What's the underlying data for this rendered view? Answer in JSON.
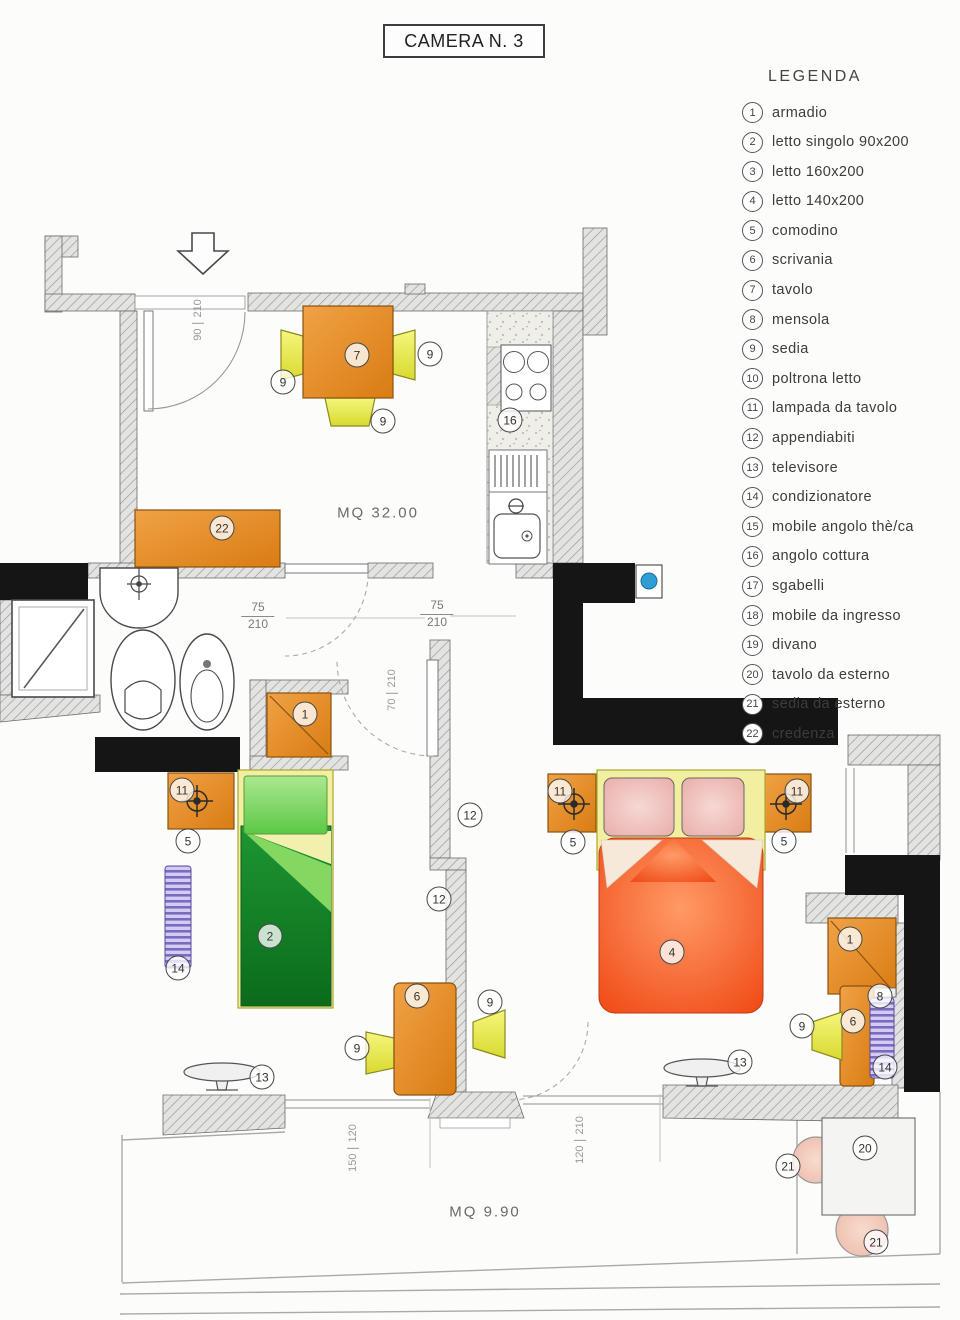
{
  "title": "CAMERA N. 3",
  "legend": {
    "heading": "LEGENDA",
    "items": [
      {
        "num": "1",
        "label": "armadio"
      },
      {
        "num": "2",
        "label": "letto singolo 90x200"
      },
      {
        "num": "3",
        "label": "letto 160x200"
      },
      {
        "num": "4",
        "label": "letto 140x200"
      },
      {
        "num": "5",
        "label": "comodino"
      },
      {
        "num": "6",
        "label": "scrivania"
      },
      {
        "num": "7",
        "label": "tavolo"
      },
      {
        "num": "8",
        "label": "mensola"
      },
      {
        "num": "9",
        "label": "sedia"
      },
      {
        "num": "10",
        "label": "poltrona letto"
      },
      {
        "num": "11",
        "label": "lampada da tavolo"
      },
      {
        "num": "12",
        "label": "appendiabiti"
      },
      {
        "num": "13",
        "label": "televisore"
      },
      {
        "num": "14",
        "label": "condizionatore"
      },
      {
        "num": "15",
        "label": "mobile angolo thè/ca"
      },
      {
        "num": "16",
        "label": "angolo cottura"
      },
      {
        "num": "17",
        "label": "sgabelli"
      },
      {
        "num": "18",
        "label": "mobile da ingresso"
      },
      {
        "num": "19",
        "label": "divano"
      },
      {
        "num": "20",
        "label": "tavolo da esterno"
      },
      {
        "num": "21",
        "label": "sedia da esterno"
      },
      {
        "num": "22",
        "label": "credenza"
      }
    ]
  },
  "plan": {
    "area_labels": [
      {
        "text": "MQ 32.00",
        "x": 378,
        "y": 513
      },
      {
        "text": "MQ 9.90",
        "x": 485,
        "y": 1212
      }
    ],
    "markers": [
      {
        "n": "7",
        "x": 357,
        "y": 355
      },
      {
        "n": "9",
        "x": 283,
        "y": 382
      },
      {
        "n": "9",
        "x": 430,
        "y": 354
      },
      {
        "n": "9",
        "x": 383,
        "y": 421
      },
      {
        "n": "16",
        "x": 510,
        "y": 420
      },
      {
        "n": "22",
        "x": 222,
        "y": 528
      },
      {
        "n": "1",
        "x": 305,
        "y": 714
      },
      {
        "n": "12",
        "x": 470,
        "y": 815
      },
      {
        "n": "12",
        "x": 439,
        "y": 899
      },
      {
        "n": "11",
        "x": 182,
        "y": 790
      },
      {
        "n": "5",
        "x": 188,
        "y": 841
      },
      {
        "n": "2",
        "x": 270,
        "y": 936
      },
      {
        "n": "14",
        "x": 178,
        "y": 968
      },
      {
        "n": "13",
        "x": 262,
        "y": 1077
      },
      {
        "n": "6",
        "x": 417,
        "y": 996
      },
      {
        "n": "9",
        "x": 357,
        "y": 1048
      },
      {
        "n": "9",
        "x": 490,
        "y": 1002
      },
      {
        "n": "11",
        "x": 560,
        "y": 791
      },
      {
        "n": "5",
        "x": 573,
        "y": 842
      },
      {
        "n": "11",
        "x": 797,
        "y": 791
      },
      {
        "n": "5",
        "x": 784,
        "y": 841
      },
      {
        "n": "4",
        "x": 672,
        "y": 952
      },
      {
        "n": "1",
        "x": 850,
        "y": 939
      },
      {
        "n": "8",
        "x": 880,
        "y": 996
      },
      {
        "n": "6",
        "x": 853,
        "y": 1021
      },
      {
        "n": "9",
        "x": 802,
        "y": 1026
      },
      {
        "n": "14",
        "x": 885,
        "y": 1067
      },
      {
        "n": "13",
        "x": 740,
        "y": 1062
      },
      {
        "n": "21",
        "x": 788,
        "y": 1166
      },
      {
        "n": "20",
        "x": 865,
        "y": 1148
      },
      {
        "n": "21",
        "x": 876,
        "y": 1242
      }
    ],
    "dim_fractions": [
      {
        "top": "75",
        "bottom": "210",
        "x": 258,
        "y": 600
      },
      {
        "top": "75",
        "bottom": "210",
        "x": 437,
        "y": 598
      }
    ],
    "dim_vertical": [
      {
        "a": "90",
        "b": "210",
        "x": 198,
        "y": 320
      },
      {
        "a": "70",
        "b": "210",
        "x": 392,
        "y": 690
      },
      {
        "a": "150",
        "b": "120",
        "x": 353,
        "y": 1148
      },
      {
        "a": "120",
        "b": "210",
        "x": 580,
        "y": 1140
      }
    ]
  },
  "colors": {
    "furniture_orange": "#e08a1e",
    "chair_yellow": "#e9e94a",
    "bed_green": "#12832a",
    "bed_red": "#f2571c",
    "pillow_pink": "#eebbb6",
    "radiator_purple": "#8d7bc9",
    "fixture_blue": "#2e9fd4",
    "wall_black": "#151515",
    "wall_hatch": "#e3e3e1"
  }
}
